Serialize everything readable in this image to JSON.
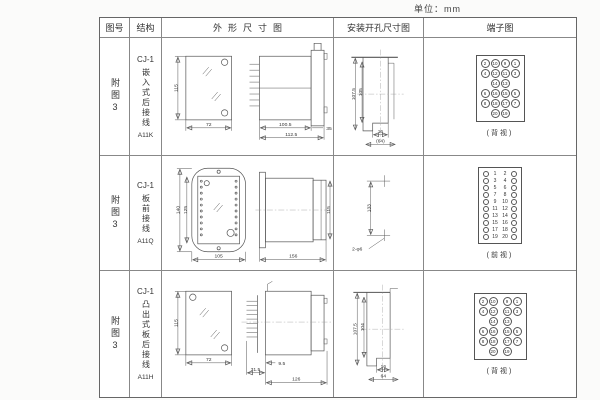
{
  "page": {
    "unit": "单位：mm"
  },
  "header": {
    "fig_no": "图号",
    "structure": "结构",
    "outline": "外形尺寸图",
    "install": "安装开孔尺寸图",
    "terminal": "端子图"
  },
  "rows": [
    {
      "fig": "附图3",
      "model": "CJ-1",
      "structure": "嵌入式后接线",
      "code": "A11K",
      "outline": {
        "front_h": "115",
        "front_w": "72",
        "body_len": "100.5",
        "total_len": "112.5",
        "flange": "35"
      },
      "install": {
        "outer_h": "107.5",
        "inner_h": "105",
        "slot_w": "16",
        "width": "(64)"
      },
      "terminal": {
        "view": "(背视)",
        "style": "grid",
        "grid": [
          [
            2,
            10,
            9,
            1
          ],
          [
            4,
            12,
            11,
            3
          ],
          [
            null,
            14,
            13,
            null
          ],
          [
            6,
            16,
            15,
            5
          ],
          [
            8,
            18,
            17,
            7
          ],
          [
            null,
            20,
            19,
            null
          ]
        ]
      }
    },
    {
      "fig": "附图3",
      "model": "CJ-1",
      "structure": "板前接线",
      "code": "A11Q",
      "outline": {
        "front_h_outer": "140",
        "front_h_inner": "125",
        "front_w": "105",
        "side_len": "156",
        "side_h": "115"
      },
      "install": {
        "pitch": "133",
        "holes": "2-φ6"
      },
      "terminal": {
        "view": "(前视)",
        "style": "pairs",
        "pairs": [
          [
            1,
            2
          ],
          [
            3,
            4
          ],
          [
            5,
            6
          ],
          [
            7,
            8
          ],
          [
            9,
            10
          ],
          [
            11,
            12
          ],
          [
            13,
            14
          ],
          [
            15,
            16
          ],
          [
            17,
            18
          ],
          [
            19,
            20
          ]
        ]
      }
    },
    {
      "fig": "附图3",
      "model": "CJ-1",
      "structure": "凸出式板后接线",
      "code": "A11H",
      "outline": {
        "front_h": "115",
        "front_w": "72",
        "pin_len": "31.5",
        "offset": "9.5",
        "side_len": "126"
      },
      "install": {
        "outer_h": "107.5",
        "inner_h": "104",
        "slot_w": "16",
        "width": "64"
      },
      "terminal": {
        "view": "(背视)",
        "style": "grid",
        "center_gap": true,
        "grid": [
          [
            2,
            10,
            9,
            1
          ],
          [
            4,
            12,
            11,
            3
          ],
          [
            null,
            14,
            13,
            null
          ],
          [
            6,
            16,
            15,
            5
          ],
          [
            8,
            18,
            17,
            7
          ],
          [
            null,
            20,
            19,
            null
          ]
        ]
      }
    }
  ]
}
